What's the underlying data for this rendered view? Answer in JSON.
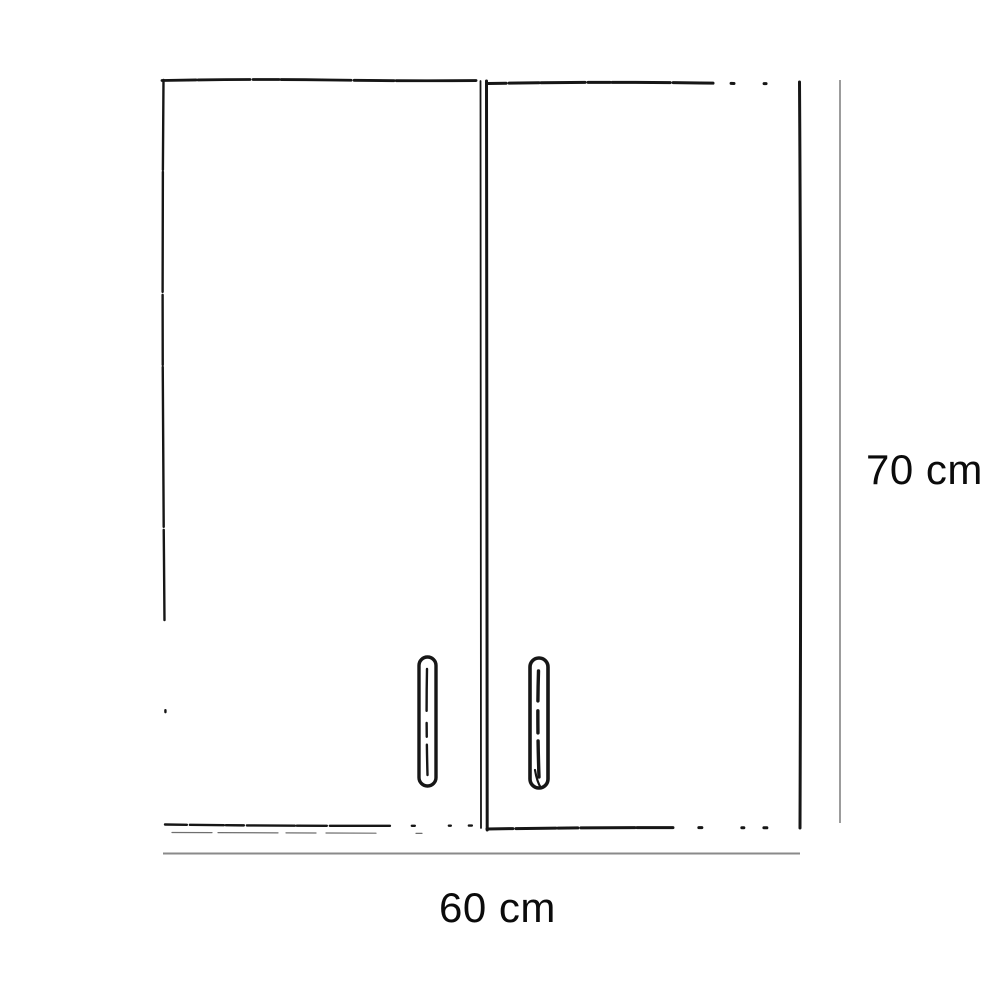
{
  "diagram": {
    "kind": "two-door cabinet dimension drawing",
    "height_label": "70 cm",
    "width_label": "60 cm",
    "height_value_cm": 70,
    "width_value_cm": 60,
    "colors": {
      "sketch_line": "#161616",
      "dimension_line": "#8a8a8a",
      "label_text": "#0b0b0b",
      "background": "#ffffff"
    }
  }
}
